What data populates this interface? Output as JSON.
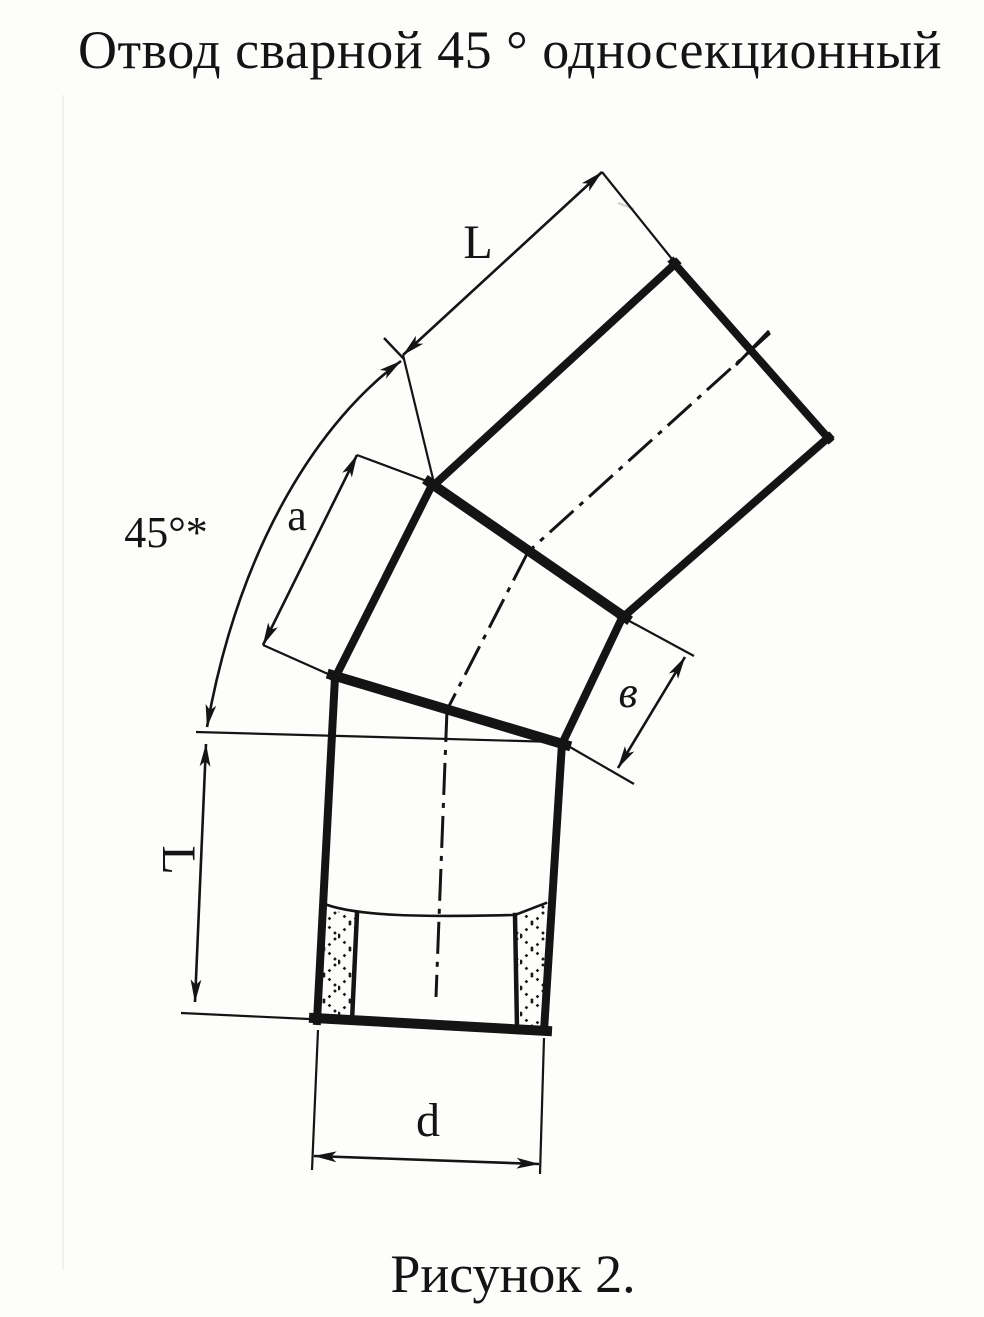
{
  "title": "Отвод сварной 45 ° односекционный",
  "figure": {
    "caption": "Рисунок 2.",
    "kind": "technical-drawing",
    "subject": "welded 45-degree single-section pipe elbow",
    "dimension_labels": {
      "upper_pipe_length": "L",
      "bend_angle": "45°*",
      "outer_seam_segment": "a",
      "inner_seam_segment": "в",
      "lower_pipe_length": "L",
      "pipe_diameter": "d"
    },
    "colors": {
      "ink": "#141414",
      "paper": "#fdfdfb"
    }
  }
}
